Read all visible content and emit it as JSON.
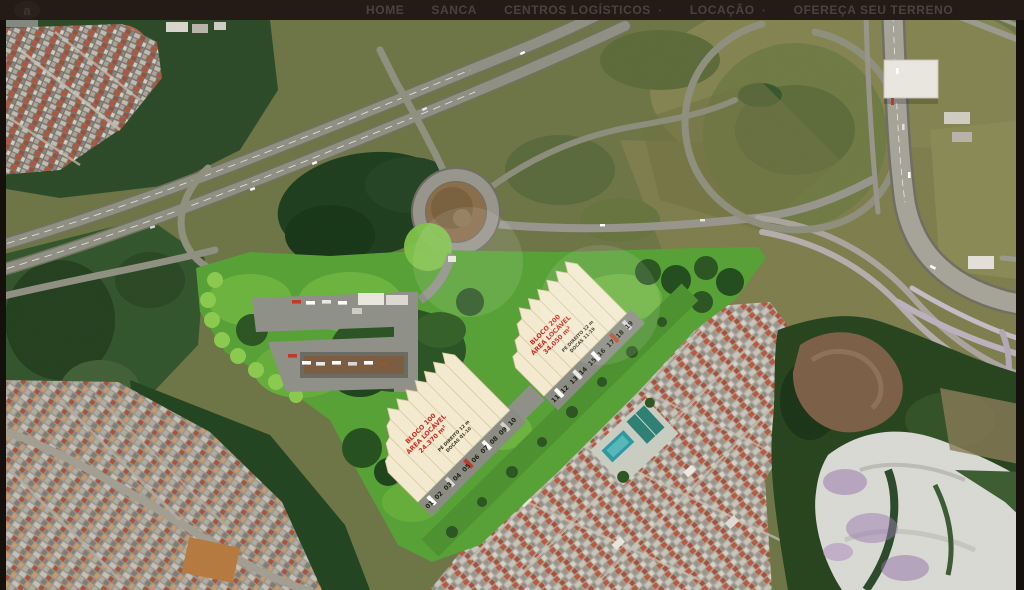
{
  "nav": {
    "logo_glyph": "a",
    "dropdown_glyph": "·",
    "items": [
      {
        "label": "HOME",
        "has_dropdown": false
      },
      {
        "label": "SANCA",
        "has_dropdown": false
      },
      {
        "label": "CENTROS LOGÍSTICOS",
        "has_dropdown": true
      },
      {
        "label": "LOCAÇÃO",
        "has_dropdown": true
      },
      {
        "label": "OFEREÇA SEU TERRENO",
        "has_dropdown": false
      }
    ]
  },
  "masterplan": {
    "blocks": [
      {
        "id": "bloco-100",
        "label_red": [
          "BLOCO 100",
          "ÁREA LOCÁVEL",
          "24.370 m²"
        ],
        "label_dark": [
          "PÉ DIREITO 12 m",
          "DOCAS 01-10"
        ],
        "dock_numbers": [
          "01",
          "02",
          "03",
          "04",
          "05",
          "06",
          "07",
          "08",
          "09",
          "10"
        ]
      },
      {
        "id": "bloco-200",
        "label_red": [
          "BLOCO 200",
          "ÁREA LOCÁVEL",
          "34.050 m²"
        ],
        "label_dark": [
          "PÉ DIREITO 12 m",
          "DOCAS 11-19"
        ],
        "dock_numbers": [
          "11",
          "12",
          "13",
          "14",
          "15",
          "16",
          "17",
          "18",
          "19"
        ]
      }
    ],
    "colors": {
      "warehouse_roof": "#f4ead0",
      "site_green": "#57a136",
      "label_red": "#cf2b1f",
      "water_white": "#d9d9d4",
      "water_purple": "#9a79ad",
      "nav_background": "#241b17"
    }
  }
}
